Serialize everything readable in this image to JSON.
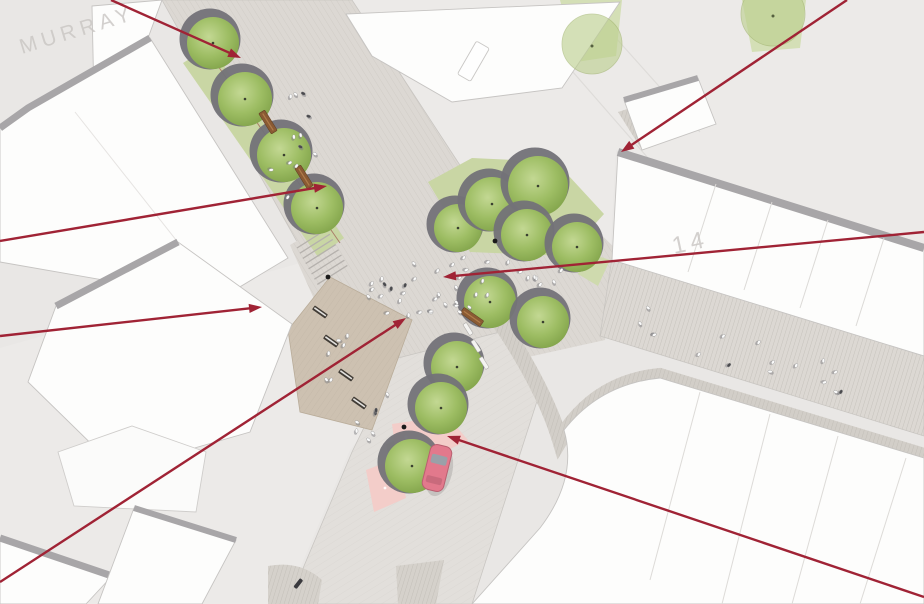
{
  "plan": {
    "type": "masterplan-aerial-rendering",
    "watermarks": [
      {
        "text": "MURRAY",
        "x": 22,
        "y": 54,
        "angle": -17,
        "size": 21
      },
      {
        "text": "14",
        "x": 674,
        "y": 254,
        "angle": -12,
        "size": 24
      }
    ]
  },
  "palette": {
    "ground": "#e9e7e5",
    "ground_light": "#eeedec",
    "street": "#dcd8d3",
    "street_south": "#e2dfdb",
    "plaza": "#dcd8d3",
    "terrace": "#cdc1b1",
    "grass": "#c9d6a4",
    "grass_light": "#d4dfb6",
    "building": "#fdfdfc",
    "building_outline": "#c6c4c2",
    "wall": "#a8a6a8",
    "kerb": "#c9c6c2",
    "hatch": "#c3beb8",
    "terrace_hatch": "#bdb2a2",
    "tree_planter": "#737278",
    "tree_edge": "#7fa148",
    "tree_mid": "#9dbd63",
    "tree_light": "#bfd68c",
    "tree_pale": "#bccf8e",
    "bench_wood": "#8a5a33",
    "bench_dark": "#413c36",
    "bench_white": "#f4f3f1",
    "bollard": "#1a1a1a",
    "pink": "#f3cdc9",
    "car_body": "#e2798c",
    "car_glass": "#9aa0a8",
    "person": "#fafafa",
    "person_dark": "#4a4a4e",
    "arrow": "#a02335",
    "watermark": "#c9c6c3",
    "median_edge": "#a4695c"
  },
  "annotations": {
    "arrow_count": 7,
    "arrows": [
      {
        "name": "arrow-murray-top",
        "x1": 111,
        "y1": 0,
        "x2": 241,
        "y2": 58
      },
      {
        "name": "arrow-northeast-kerb",
        "x1": 847,
        "y1": 0,
        "x2": 621,
        "y2": 152
      },
      {
        "name": "arrow-murray-median",
        "x1": 0,
        "y1": 241,
        "x2": 327,
        "y2": 186
      },
      {
        "name": "arrow-west-building",
        "x1": 0,
        "y1": 336,
        "x2": 262,
        "y2": 307
      },
      {
        "name": "arrow-plaza-centre",
        "x1": 924,
        "y1": 232,
        "x2": 443,
        "y2": 277
      },
      {
        "name": "arrow-terrace-paving",
        "x1": 0,
        "y1": 582,
        "x2": 406,
        "y2": 318
      },
      {
        "name": "arrow-cycle-crossing",
        "x1": 924,
        "y1": 597,
        "x2": 447,
        "y2": 436
      }
    ]
  },
  "scene": {
    "trees": [
      {
        "x": 213,
        "y": 43,
        "r": 26
      },
      {
        "x": 245,
        "y": 99,
        "r": 27
      },
      {
        "x": 284,
        "y": 155,
        "r": 27
      },
      {
        "x": 317,
        "y": 208,
        "r": 26
      },
      {
        "x": 458,
        "y": 228,
        "r": 24
      },
      {
        "x": 492,
        "y": 204,
        "r": 27
      },
      {
        "x": 538,
        "y": 186,
        "r": 30
      },
      {
        "x": 527,
        "y": 235,
        "r": 26
      },
      {
        "x": 577,
        "y": 247,
        "r": 25
      },
      {
        "x": 490,
        "y": 302,
        "r": 26
      },
      {
        "x": 543,
        "y": 322,
        "r": 26
      },
      {
        "x": 457,
        "y": 367,
        "r": 26
      },
      {
        "x": 441,
        "y": 408,
        "r": 26
      },
      {
        "x": 412,
        "y": 466,
        "r": 27
      }
    ],
    "pale_trees": [
      {
        "x": 592,
        "y": 44,
        "r": 30
      },
      {
        "x": 773,
        "y": 14,
        "r": 32
      }
    ],
    "benches_wood": [
      {
        "x": 268,
        "y": 122,
        "angle": 58
      },
      {
        "x": 304,
        "y": 177,
        "angle": 58
      },
      {
        "x": 472,
        "y": 317,
        "angle": 35
      }
    ],
    "benches_dark": [
      {
        "x": 320,
        "y": 312,
        "angle": 35
      },
      {
        "x": 331,
        "y": 341,
        "angle": 35
      },
      {
        "x": 346,
        "y": 375,
        "angle": 35
      },
      {
        "x": 359,
        "y": 403,
        "angle": 35
      }
    ],
    "benches_white": [
      {
        "x": 468,
        "y": 329,
        "angle": 58
      },
      {
        "x": 476,
        "y": 346,
        "angle": 58
      },
      {
        "x": 484,
        "y": 363,
        "angle": 58
      }
    ],
    "bollards": [
      {
        "x": 328,
        "y": 277
      },
      {
        "x": 495,
        "y": 241
      },
      {
        "x": 404,
        "y": 427
      }
    ],
    "car": {
      "x": 437,
      "y": 468,
      "angle": 14
    },
    "people_clusters": [
      {
        "name": "plaza",
        "x": 455,
        "y": 290,
        "rx": 95,
        "ry": 42,
        "count": 26,
        "slope": 0
      },
      {
        "name": "plaza-west",
        "x": 390,
        "y": 300,
        "rx": 40,
        "ry": 28,
        "count": 8,
        "slope": 0
      },
      {
        "name": "murray-street",
        "x": 298,
        "y": 140,
        "rx": 30,
        "ry": 80,
        "count": 12,
        "slope": 0
      },
      {
        "name": "top-plaza",
        "x": 520,
        "y": 272,
        "rx": 55,
        "ry": 26,
        "count": 8,
        "slope": 0
      },
      {
        "name": "right-street",
        "x": 762,
        "y": 362,
        "rx": 138,
        "ry": 30,
        "count": 16,
        "slope": 0.31
      },
      {
        "name": "south-street",
        "x": 368,
        "y": 425,
        "rx": 36,
        "ry": 46,
        "count": 7,
        "slope": 0
      },
      {
        "name": "terrace",
        "x": 338,
        "y": 352,
        "rx": 26,
        "ry": 42,
        "count": 6,
        "slope": 0
      }
    ]
  }
}
